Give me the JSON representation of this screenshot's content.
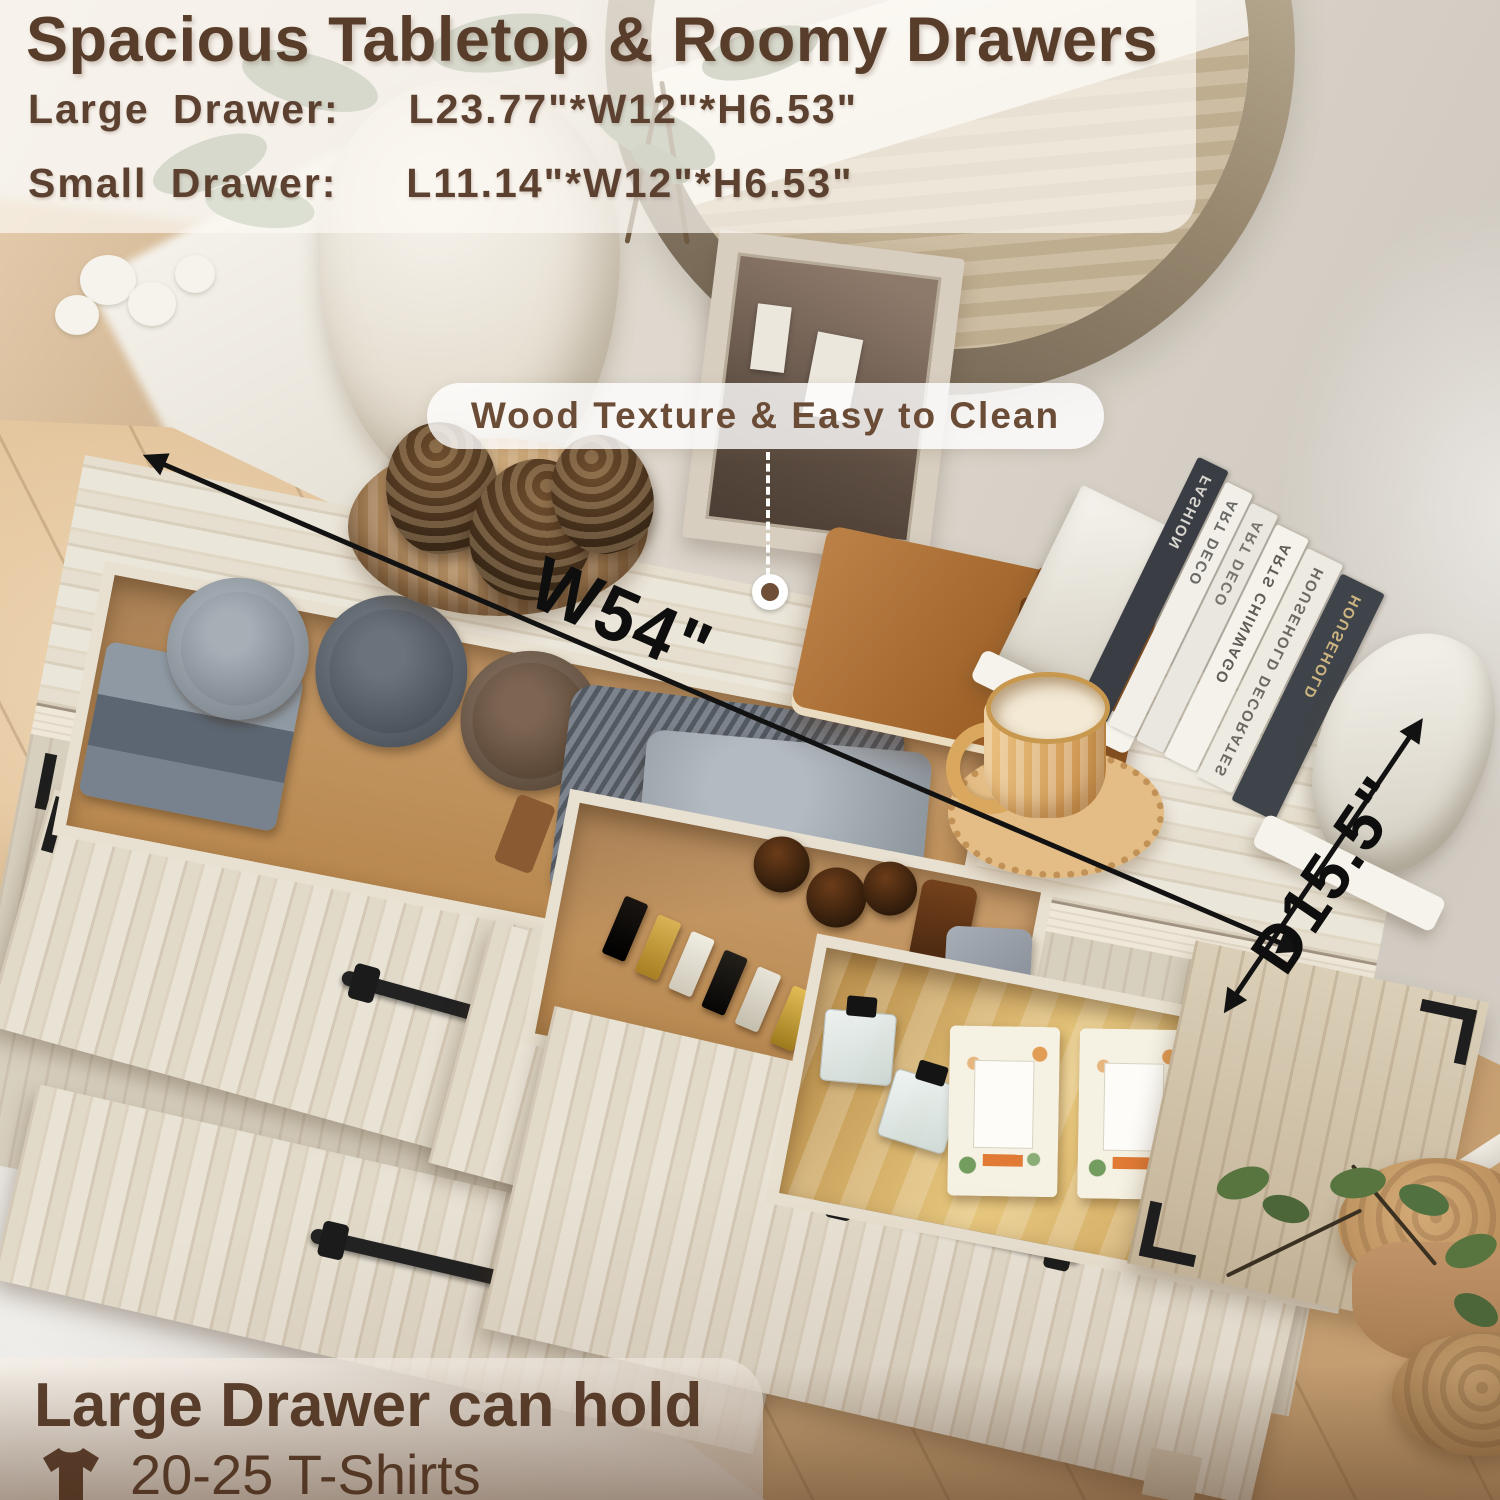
{
  "header": {
    "title": "Spacious Tabletop & Roomy Drawers",
    "specs": [
      {
        "label": "Large Drawer:",
        "size": "L23.77\"*W12\"*H6.53\""
      },
      {
        "label": "Small Drawer:",
        "size": "L11.14\"*W12\"*H6.53\""
      }
    ]
  },
  "callout": {
    "text": "Wood Texture & Easy to Clean"
  },
  "dimensions": {
    "width": "W54\"",
    "depth": "D15.5\""
  },
  "footer": {
    "title": "Large Drawer can hold",
    "capacity": "20-25 T-Shirts",
    "icon": "t-shirt-icon"
  },
  "books": {
    "spines": [
      "FASHION",
      "ART DECO",
      "ART DECO",
      "ARTS CHINWAGO",
      "HOUSEHOLD DECORATES",
      "HOUSEHOLD"
    ]
  },
  "colors": {
    "accent_brown": "#5a3e2b",
    "text_brown": "#5d4130",
    "dimension_black": "#121212",
    "overlay_white": "rgba(252,249,243,0.68)",
    "wood_light": "#e5ddcc",
    "floor_tan": "#d6b285",
    "gold_liner": "#d2a963"
  }
}
